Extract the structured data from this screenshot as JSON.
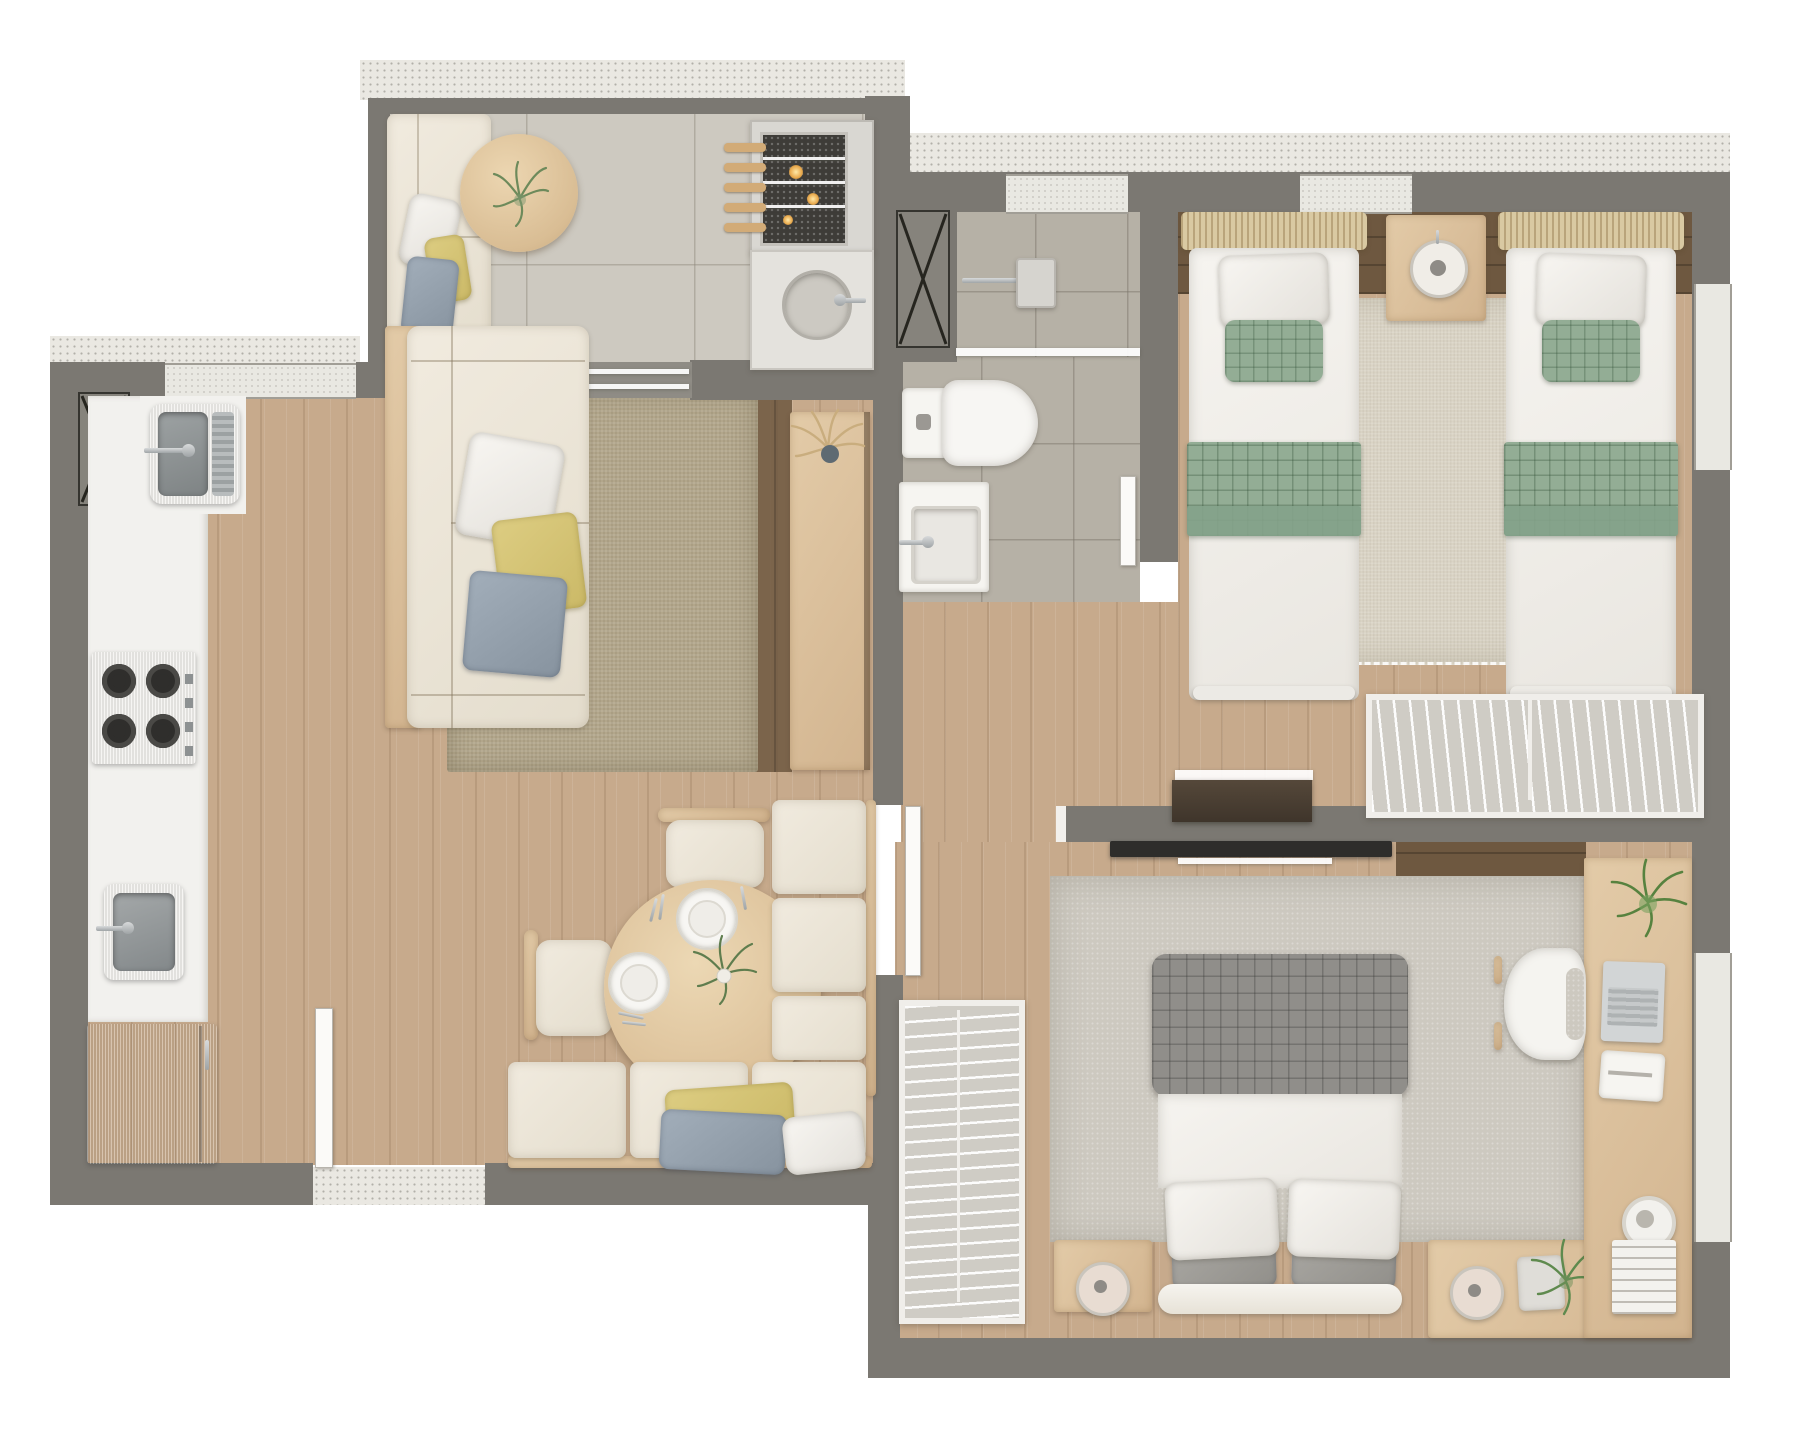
{
  "meta": {
    "title": "Apartment 3D floor plan – top view render",
    "view": "top-down architectural render",
    "visible_text": "none"
  },
  "palette": {
    "wall": "#7b7872",
    "terr": "#eae8e2",
    "tileBalc": "#cdc9c0",
    "tileBath": "#b6b1a6",
    "wood": "#c7aa8c",
    "walnut": "#6e5840",
    "rugJute": "#b2a68b",
    "rugTwin": "#d9d3c4",
    "rugMaster": "#cdc9c0",
    "green": "#93ad95",
    "quilt": "#908e8a",
    "tvDark": "#2e2d2b"
  },
  "rooms": [
    {
      "id": "balcony",
      "features": [
        "outdoor-sofa",
        "round-coffee-table",
        "barbecue-grill-with-skewers",
        "grill-counter-round-sink",
        "sliding-glass-door",
        "tile-floor"
      ]
    },
    {
      "id": "kitchen",
      "features": [
        "white-counter",
        "stainless-sink-with-drainboard",
        "gas-cooktop-4-burners",
        "prep-sink",
        "refrigerator",
        "window",
        "vent-shaft"
      ]
    },
    {
      "id": "living-dining",
      "features": [
        "sofa-with-pillows",
        "jute-rug",
        "wood-sideboard-with-pampas",
        "round-dining-table-set-for-two",
        "two-chairs",
        "l-shaped-banquette-with-pillows",
        "entry-door"
      ]
    },
    {
      "id": "bathroom",
      "features": [
        "shower-with-glass",
        "toilet",
        "washbasin-counter",
        "vent-shaft",
        "door"
      ]
    },
    {
      "id": "twin-bedroom",
      "features": [
        "two-single-beds-green-bedding",
        "shared-nightstand-with-lamp",
        "beige-rug",
        "open-wardrobe-with-hangers",
        "dark-media-console",
        "windows"
      ]
    },
    {
      "id": "master-bedroom",
      "features": [
        "double-bed-gray-quilt",
        "two-nightstands-with-lamps",
        "open-closet-with-hangers",
        "l-shaped-desk-with-laptop",
        "desk-chair",
        "tv-panel",
        "plants",
        "books",
        "window"
      ]
    }
  ]
}
